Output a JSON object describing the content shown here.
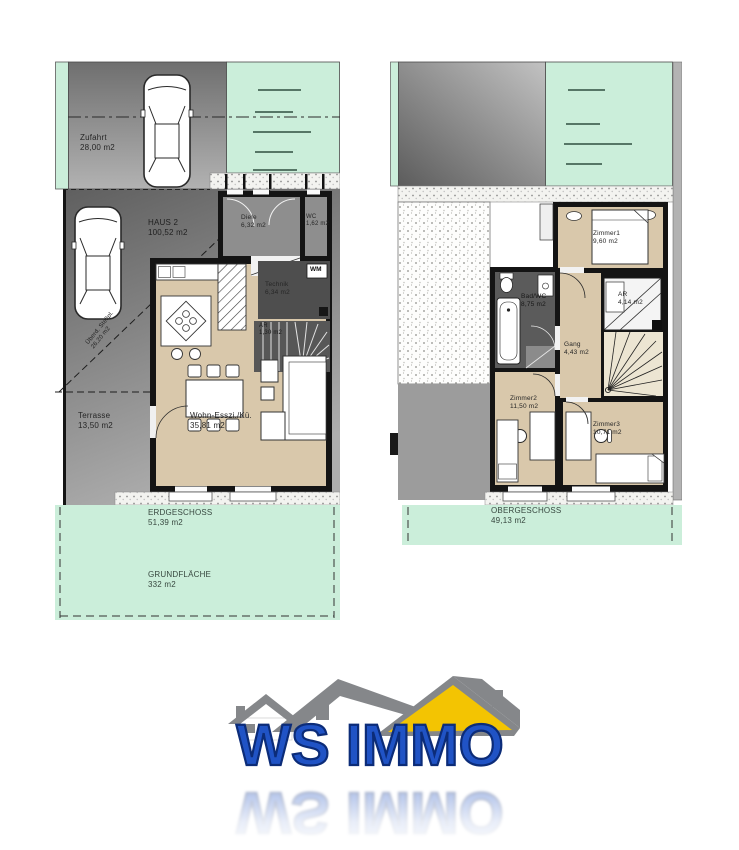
{
  "ground_floor": {
    "zufahrt": {
      "name": "Zufahrt",
      "area": "28,00 m2"
    },
    "haus": {
      "name": "HAUS 2",
      "area": "100,52 m2"
    },
    "diele": {
      "name": "Diele",
      "area": "6,32 m2"
    },
    "wc": {
      "name": "WC",
      "area": "1,62 m2"
    },
    "wm": "WM",
    "technik": {
      "name": "Technik",
      "area": "6,34 m2"
    },
    "abstellraum": {
      "name": "AR",
      "area": "1,30 m2"
    },
    "stellplatz": {
      "name": "Überd. Stellpl.",
      "area": "26,20 m2"
    },
    "terrasse": {
      "name": "Terrasse",
      "area": "13,50 m2"
    },
    "wohnen": {
      "name": "Wohn-Esszi./Kü.",
      "area": "35,81 m2"
    },
    "geschoss": {
      "name": "ERDGESCHOSS",
      "area": "51,39 m2"
    },
    "grundflaeche": {
      "name": "GRUNDFLÄCHE",
      "area": "332 m2"
    }
  },
  "upper_floor": {
    "zimmer1": {
      "name": "Zimmer1",
      "area": "9,60 m2"
    },
    "bad": {
      "name": "Bad/WC",
      "area": "8,75 m2"
    },
    "abstellraum": {
      "name": "AR",
      "area": "4,14 m2"
    },
    "gang": {
      "name": "Gang",
      "area": "4,43 m2"
    },
    "zimmer2": {
      "name": "Zimmer2",
      "area": "11,50 m2"
    },
    "zimmer3": {
      "name": "Zimmer3",
      "area": "10,71 m2"
    },
    "geschoss": {
      "name": "OBERGESCHOSS",
      "area": "49,13 m2"
    }
  },
  "logo": {
    "text": "WS IMMO"
  },
  "colors": {
    "lawn_mint": "#cbeeda",
    "floor_beige": "#d9c8ab",
    "room_gray": "#8e8e8e",
    "room_dark": "#4e4e4e",
    "wall_black": "#141414",
    "logo_blue": "#2053c5",
    "logo_outline": "#0c2c78",
    "roof_gray": "#85878a",
    "roof_yellow": "#f3c402"
  }
}
